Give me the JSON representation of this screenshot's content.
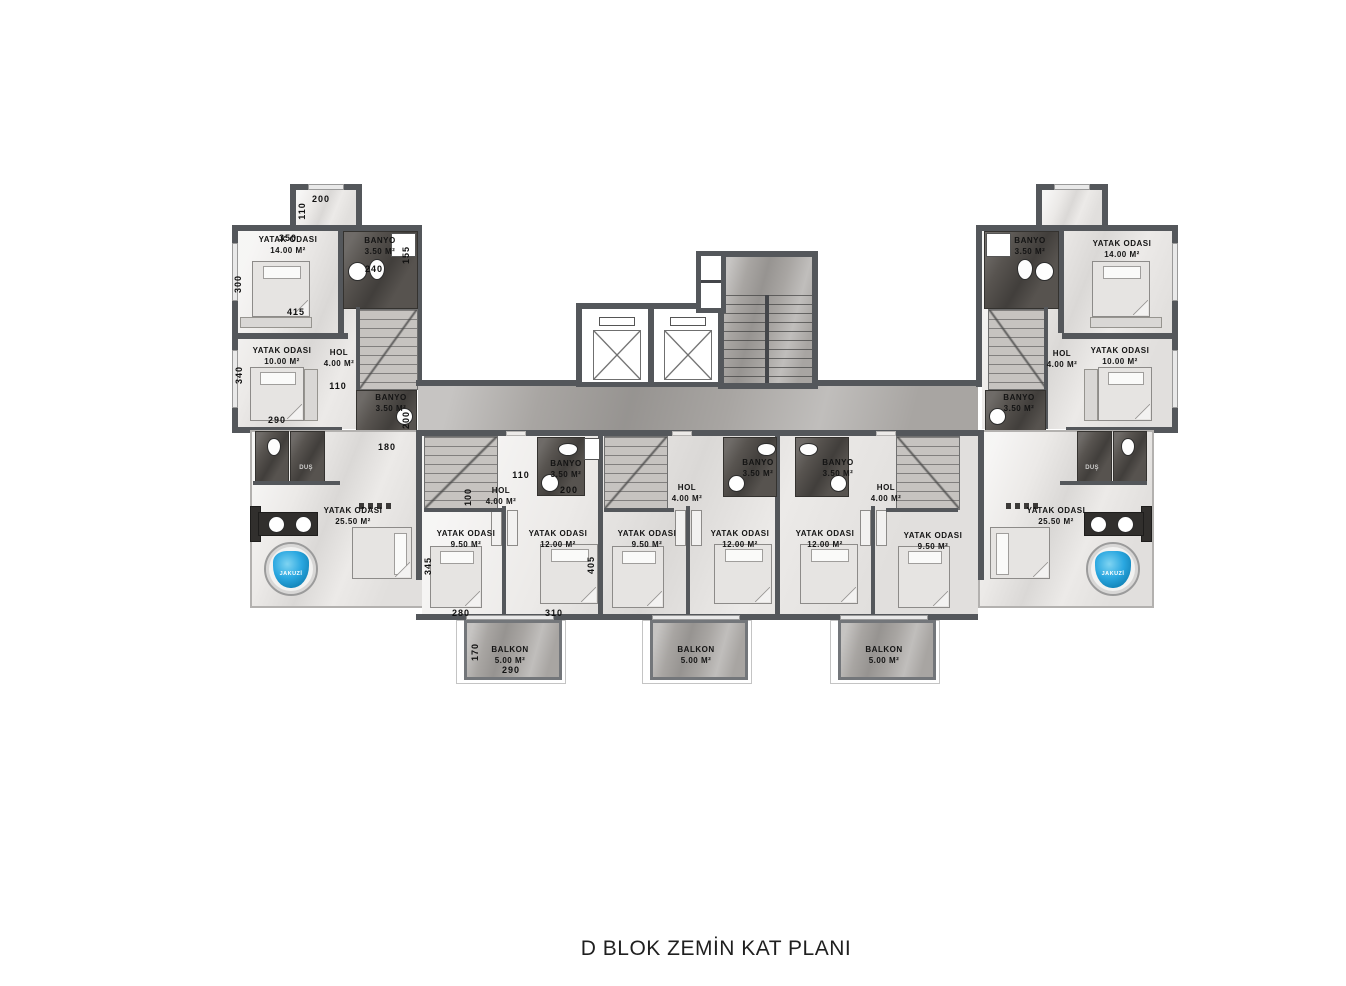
{
  "title": "D  BLOK ZEMİN KAT PLANI",
  "plan": {
    "rooms": {
      "bedroom_14": {
        "name": "YATAK ODASI",
        "area": "14.00 M²"
      },
      "bedroom_10": {
        "name": "YATAK ODASI",
        "area": "10.00 M²"
      },
      "bedroom_25": {
        "name": "YATAK ODASI",
        "area": "25.50 M²"
      },
      "bedroom_9": {
        "name": "YATAK ODASI",
        "area": "9.50 M²"
      },
      "bedroom_12": {
        "name": "YATAK ODASI",
        "area": "12.00 M²"
      },
      "hol": {
        "name": "HOL",
        "area": "4.00 M²"
      },
      "banyo": {
        "name": "BANYO",
        "area": "3.50 M²"
      },
      "balkon": {
        "name": "BALKON",
        "area": "5.00 M²"
      },
      "jakuzi": {
        "name": "JAKUZİ"
      },
      "dus": {
        "name": "DUŞ"
      }
    },
    "dimensions": {
      "left_wing": {
        "entry_width": "200",
        "entry_depth": "110",
        "bedroom14_width": "350",
        "bedroom14_depth": "300",
        "bedroom14_clear": "415",
        "banyo_upper_width": "240",
        "banyo_upper_depth": "155",
        "bedroom10_depth": "340",
        "bedroom10_width": "290",
        "hol_opening": "110",
        "banyo_lower_width": "180",
        "banyo_lower_depth": "200"
      },
      "middle_unit": {
        "hol_opening": "110",
        "stair_depth": "100",
        "banyo_width": "200",
        "bedroom9_depth": "345",
        "bedroom12_depth": "405",
        "bedroom9_width": "280",
        "bedroom12_width": "310",
        "balkon_depth": "170",
        "balkon_width": "290"
      }
    },
    "colors": {
      "jakuzi_water": "#2aa7e0",
      "wall": "#54575b",
      "bath_floor": "#57534f",
      "corridor_floor": "#a8a5a2",
      "room_floor": "#eceae8"
    }
  }
}
